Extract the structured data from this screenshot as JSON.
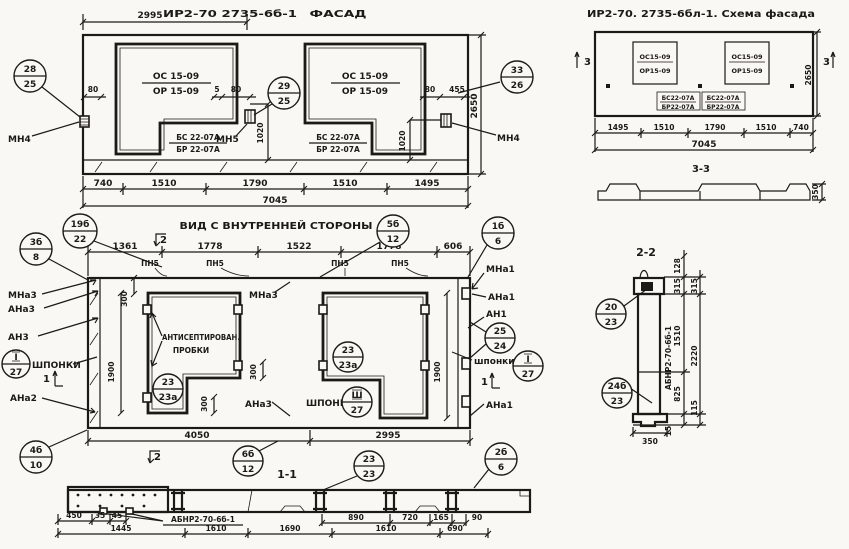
{
  "facade": {
    "dim_top": "2995",
    "code": "ИР2-70 2735-6б-1",
    "title": "ФАСАД",
    "win_left": {
      "l1": "ОС 15-09",
      "l2": "ОР 15-09"
    },
    "win_right": {
      "l1": "ОС 15-09",
      "l2": "ОР 15-09"
    },
    "blk_left": {
      "l1": "БС 22-07А",
      "l2": "БР 22-07А"
    },
    "blk_right": {
      "l1": "БС 22-07А",
      "l2": "БР 22-07А"
    },
    "mn4_left": "МН4",
    "mn5": "МН5",
    "mn4_right": "МН4",
    "d80_left": "80",
    "d5": "5",
    "d80_mid": "80",
    "d80_right": "80",
    "d455": "455",
    "d1020_mid": "1020",
    "d1020_right": "1020",
    "d2650": "2650",
    "b28": {
      "t": "28",
      "b": "25"
    },
    "b29": {
      "t": "29",
      "b": "25"
    },
    "b33": {
      "t": "33",
      "b": "26"
    },
    "dims_bottom": [
      "740",
      "1510",
      "1790",
      "1510",
      "1495"
    ],
    "total": "7045"
  },
  "scheme": {
    "title": "ИР2-70. 2735-6бл-1. Схема фасада",
    "win_left": {
      "l1": "ОС15-09",
      "l2": "ОР15-09"
    },
    "win_right": {
      "l1": "ОС15-09",
      "l2": "ОР15-09"
    },
    "blk_left": {
      "l1": "БС22-07А",
      "l2": "БР22-07А"
    },
    "blk_right": {
      "l1": "БС22-07А",
      "l2": "БР22-07А"
    },
    "mark3_left": "3",
    "mark3_right": "3",
    "d2650": "2650",
    "dims_bottom": [
      "1495",
      "1510",
      "1790",
      "1510",
      "740"
    ],
    "total": "7045",
    "sec_title": "3-3",
    "d350": "350"
  },
  "inner": {
    "title": "ВИД С ВНУТРЕННЕЙ СТОРОНЫ",
    "dims_top": [
      "1361",
      "1778",
      "1522",
      "1778",
      "606"
    ],
    "pn5": [
      "ПН5",
      "ПН5",
      "ПН5",
      "ПН5"
    ],
    "left": {
      "mna3": "МНа3",
      "ana3": "АНа3",
      "an3": "АН3",
      "shponki": "ШПОНКИ",
      "ana2": "АНа2"
    },
    "mid": {
      "mna3": "МНа3",
      "ana3": "АНа3",
      "anti1": "АНТИСЕПТИРОВАН.",
      "anti2": "ПРОБКИ",
      "shponki": "ШПОНКИ"
    },
    "right": {
      "mna1": "МНа1",
      "ana1": "АНа1",
      "an1": "АН1",
      "shponki": "шпонки",
      "ana1b": "АНа1"
    },
    "marks": {
      "m2top": "2",
      "m2bot": "2",
      "m1left": "1",
      "m1right": "1"
    },
    "d300": [
      "300",
      "300",
      "300"
    ],
    "d1900": [
      "1900",
      "1900"
    ],
    "dims_bottom": [
      "4050",
      "2995"
    ],
    "b19": {
      "t": "19б",
      "b": "22"
    },
    "b3": {
      "t": "3б",
      "b": "8"
    },
    "b5": {
      "t": "5б",
      "b": "12"
    },
    "b1": {
      "t": "1б",
      "b": "6"
    },
    "b25": {
      "t": "25",
      "b": "24"
    },
    "bIl": {
      "t": "I",
      "b": "27"
    },
    "bIr": {
      "t": "I",
      "b": "27"
    },
    "bIII": {
      "t": "Ш",
      "b": "27"
    },
    "b23l": {
      "t": "23",
      "b": "23а"
    },
    "b23r": {
      "t": "23",
      "b": "23а"
    },
    "b4": {
      "t": "4б",
      "b": "10"
    },
    "b6": {
      "t": "6б",
      "b": "12"
    },
    "b23s": {
      "t": "23",
      "b": "23"
    },
    "b2": {
      "t": "2б",
      "b": "6"
    }
  },
  "sec11": {
    "title": "1-1",
    "label": "АБНР2-70-6б-1",
    "r1l": [
      "450",
      "35",
      "45"
    ],
    "r1r": [
      "890",
      "720",
      "165",
      "90"
    ],
    "r2": [
      "1445",
      "1610",
      "1690",
      "1610",
      "690"
    ]
  },
  "sec22": {
    "title": "2-2",
    "label": "АБНР2-70-6б-1",
    "d128": "128",
    "d315a": "315",
    "d315b": "315",
    "d1510": "1510",
    "d2220": "2220",
    "d825": "825",
    "d115": "115",
    "d350": "350",
    "d15": "15",
    "b20": {
      "t": "20",
      "b": "23"
    },
    "b24": {
      "t": "24б",
      "b": "23"
    }
  }
}
